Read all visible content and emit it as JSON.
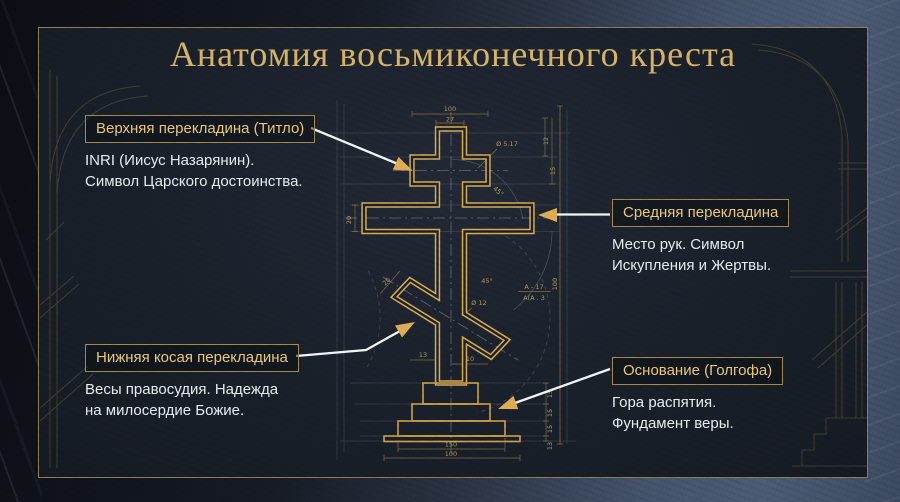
{
  "title": "Анатомия восьмиконечного креста",
  "callouts": {
    "top": {
      "label": "Верхняя перекладина (Титло)",
      "line1": "INRI (Иисус Назарянин).",
      "line2": "Символ Царского достоинства."
    },
    "middle": {
      "label": "Средняя перекладина",
      "line1": "Место рук. Символ",
      "line2": "Искупления и Жертвы."
    },
    "slant": {
      "label": "Нижняя косая перекладина",
      "line1": "Весы правосудия. Надежда",
      "line2": "на милосердие Божие."
    },
    "base": {
      "label": "Основание (Голгофа)",
      "line1": "Гора распятия.",
      "line2": "Фундамент веры."
    }
  },
  "dims": {
    "top_bar_width": "100",
    "post_width": "27",
    "hole": "Ø 5.17",
    "right_small": "12",
    "right_mid": "15",
    "total_height": "100",
    "angle_big": "45°",
    "angle_small": "45°",
    "note_num": "А - 17",
    "note_den": "А(А . 3",
    "phi": "Ø 12",
    "slant_width": "20",
    "mid_bar_height": "20",
    "slant_a": "13",
    "slant_b": "10",
    "base_width": "150",
    "plate_width": "100",
    "step1": "15",
    "step2": "15",
    "step3": "15",
    "plate_h": "13"
  },
  "colors": {
    "gold_line": "#d7ab52",
    "title_gold": "#d6b269",
    "label_gold": "#e9c87c",
    "panel_bg": "#1b212b",
    "border_olive": "#8c7f50",
    "white_text": "#e9ecef",
    "arrow_gold": "#dcae55"
  }
}
